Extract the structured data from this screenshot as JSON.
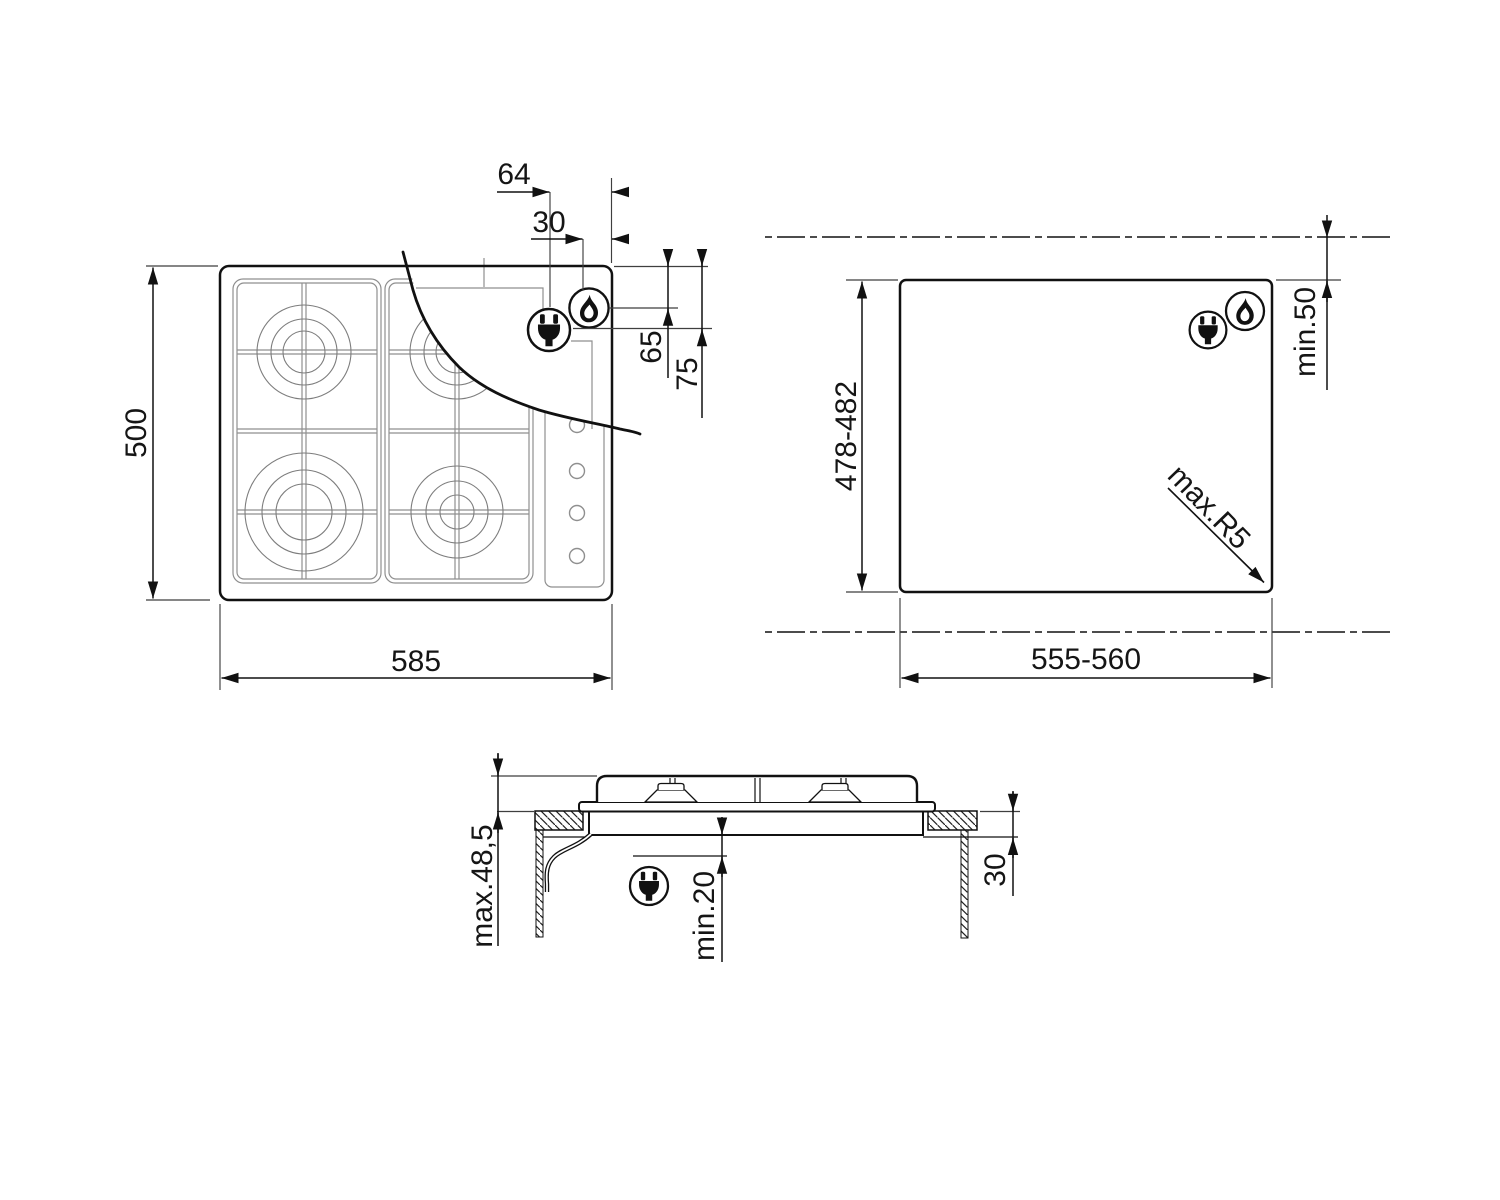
{
  "title": "Built-in gas hob installation drawing",
  "views": {
    "top": {
      "name": "hob top view",
      "width": "585",
      "height": "500",
      "plug_offset": "64",
      "gas_offset": "30",
      "gas_drop": "65",
      "plug_drop": "75"
    },
    "cutout": {
      "name": "worktop cutout view",
      "width": "555-560",
      "depth": "478-482",
      "rear_clearance": "min.50",
      "corner_radius": "max.R5"
    },
    "section": {
      "name": "side section view",
      "above_height": "max.48,5",
      "below_clearance": "min.20",
      "worktop_depth": "30"
    }
  },
  "icons": {
    "plug": "power-plug",
    "flame": "gas-flame"
  },
  "colors": {
    "line": "#111111",
    "thin_line": "#8f8f8f",
    "background": "#ffffff"
  }
}
